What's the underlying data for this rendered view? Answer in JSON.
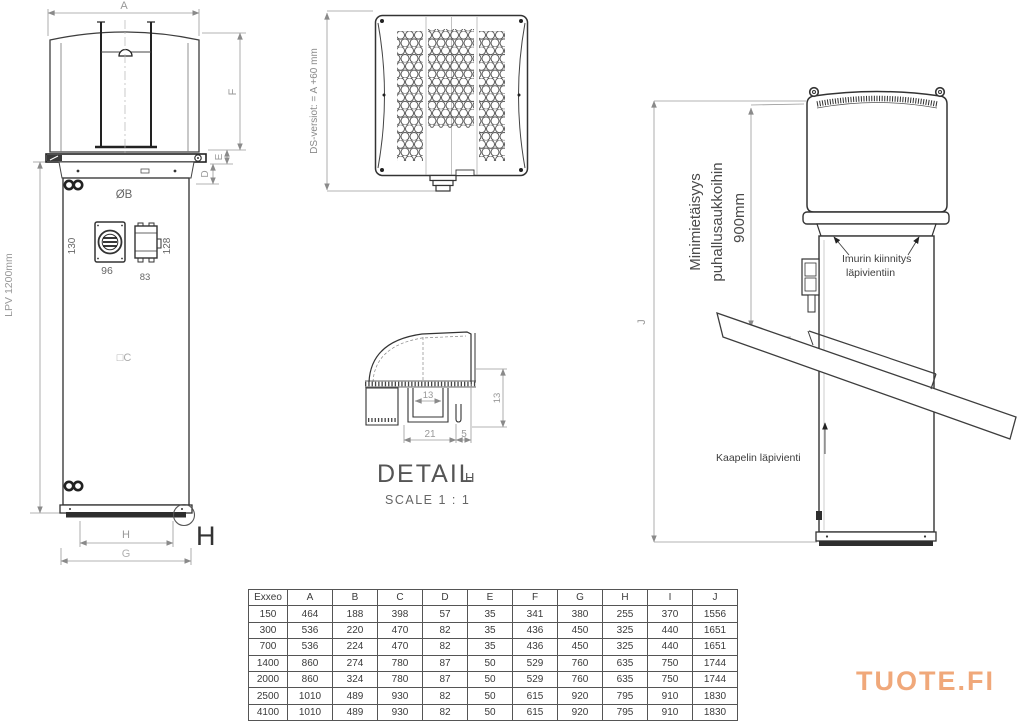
{
  "drawing": {
    "line_color": "#3d3d3d",
    "dim_color": "#999999"
  },
  "front_view": {
    "dim_a": "A",
    "dim_f": "F",
    "dim_e": "E",
    "dim_d": "D",
    "dim_diameter_b": "ØB",
    "dim_130": "130",
    "dim_128": "128",
    "dim_96": "96",
    "dim_83": "83",
    "dim_lpv": "LPV 1200mm",
    "dim_c": "□C",
    "dim_h": "H",
    "dim_g": "G",
    "detail_marker": "H"
  },
  "top_view": {
    "ds_note": "DS-versiot: = A +60 mm"
  },
  "detail_view": {
    "title": "DETAIL",
    "title_ref": "H",
    "scale_note": "SCALE 1 : 1",
    "dim_inner": "13",
    "dim_left": "21",
    "dim_right": "5",
    "dim_height": "13"
  },
  "side_view": {
    "dim_j": "J",
    "clearance_line1": "Minimietäisyys",
    "clearance_line2": "puhallusaukkoihin",
    "clearance_value": "900mm",
    "label_mount_line1": "Imurin kiinnitys",
    "label_mount_line2": "läpivientiin",
    "label_cable": "Kaapelin läpivienti"
  },
  "table": {
    "headers": [
      "Exxeo",
      "A",
      "B",
      "C",
      "D",
      "E",
      "F",
      "G",
      "H",
      "I",
      "J"
    ],
    "rows": [
      [
        "150",
        "464",
        "188",
        "398",
        "57",
        "35",
        "341",
        "380",
        "255",
        "370",
        "1556"
      ],
      [
        "300",
        "536",
        "220",
        "470",
        "82",
        "35",
        "436",
        "450",
        "325",
        "440",
        "1651"
      ],
      [
        "700",
        "536",
        "224",
        "470",
        "82",
        "35",
        "436",
        "450",
        "325",
        "440",
        "1651"
      ],
      [
        "1400",
        "860",
        "274",
        "780",
        "87",
        "50",
        "529",
        "760",
        "635",
        "750",
        "1744"
      ],
      [
        "2000",
        "860",
        "324",
        "780",
        "87",
        "50",
        "529",
        "760",
        "635",
        "750",
        "1744"
      ],
      [
        "2500",
        "1010",
        "489",
        "930",
        "82",
        "50",
        "615",
        "920",
        "795",
        "910",
        "1830"
      ],
      [
        "4100",
        "1010",
        "489",
        "930",
        "82",
        "50",
        "615",
        "920",
        "795",
        "910",
        "1830"
      ]
    ]
  },
  "logo": {
    "text": "TUOTE.FI",
    "color": "#f0a87a"
  }
}
